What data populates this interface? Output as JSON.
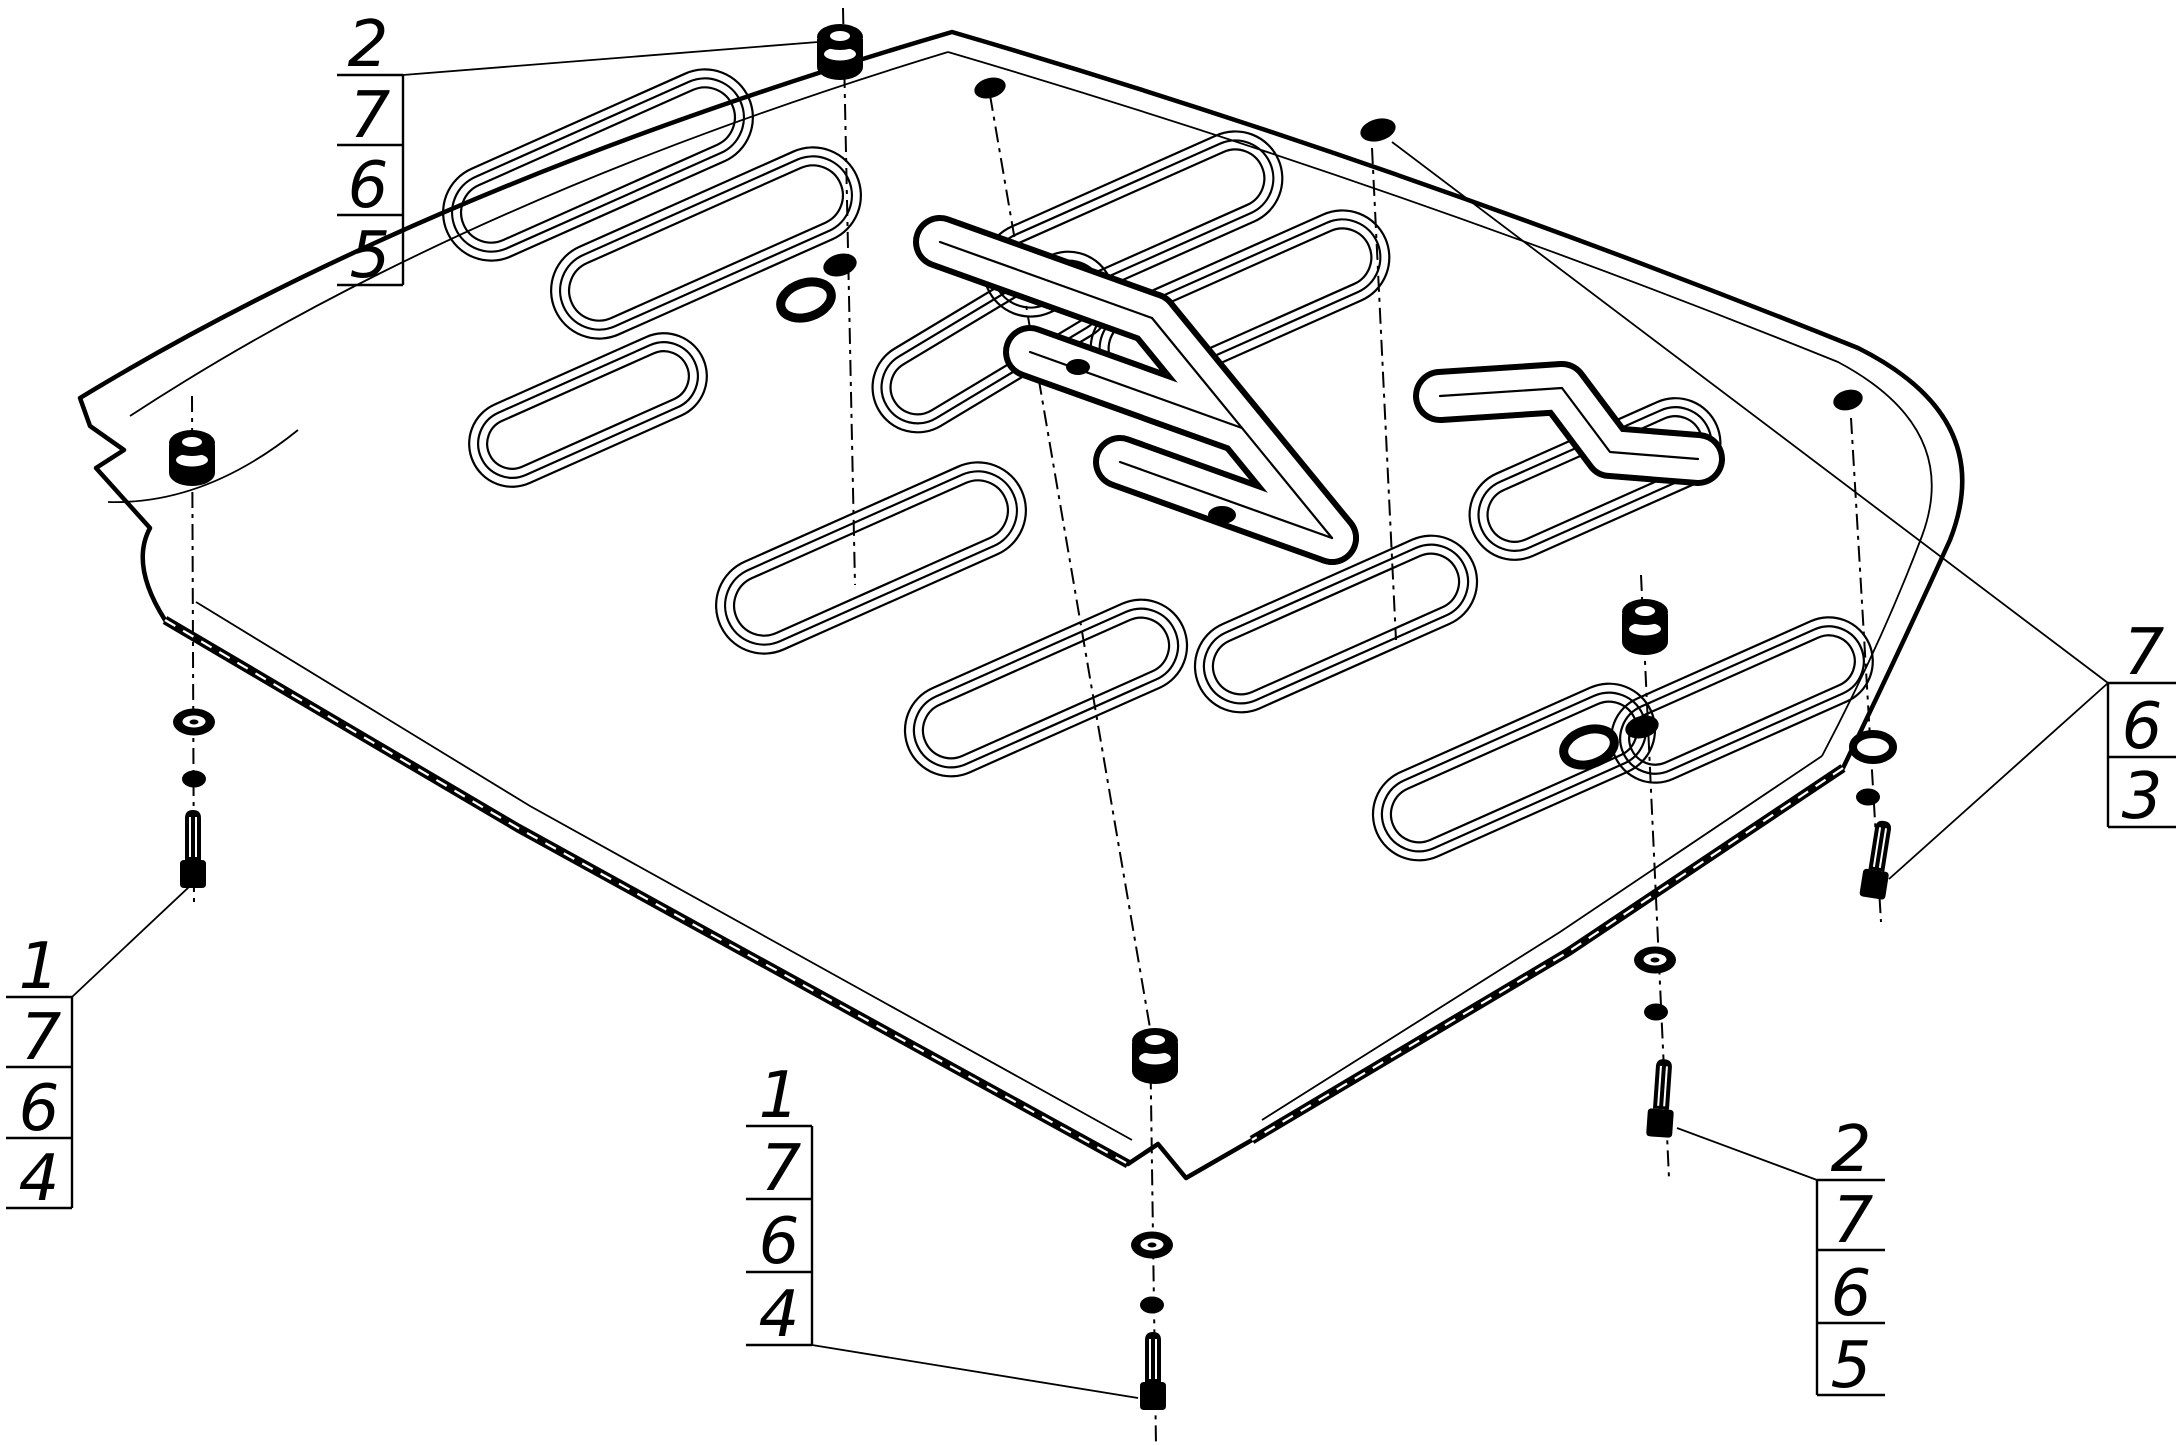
{
  "colors": {
    "line": "#000000",
    "background": "#ffffff"
  },
  "callouts": {
    "top_left": {
      "numbers": [
        "2",
        "7",
        "6",
        "5"
      ]
    },
    "left": {
      "numbers": [
        "1",
        "7",
        "6",
        "4"
      ]
    },
    "bottom_center": {
      "numbers": [
        "1",
        "7",
        "6",
        "4"
      ]
    },
    "bottom_right": {
      "numbers": [
        "2",
        "7",
        "6",
        "5"
      ]
    },
    "right": {
      "numbers": [
        "7",
        "6",
        "3"
      ]
    }
  }
}
